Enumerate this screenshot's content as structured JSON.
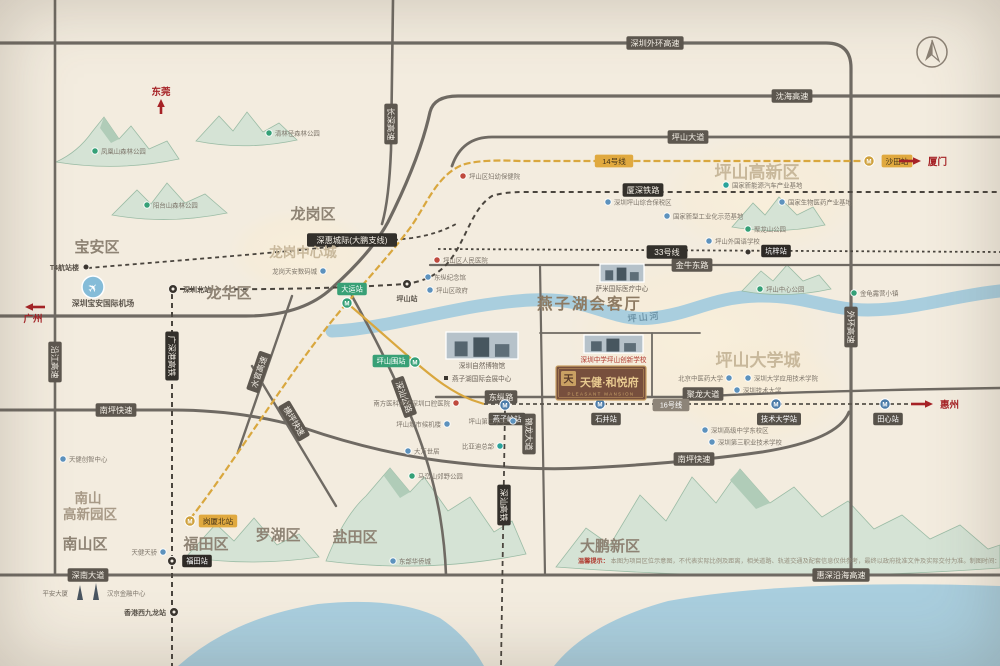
{
  "page": {
    "width": 1000,
    "height": 666,
    "bg": "#f3ecdf"
  },
  "airport": {
    "name": "深圳宝安国际机场"
  },
  "project": {
    "name": "天健·和悦府",
    "en": "PLEASANT MANSION",
    "seal": "天"
  },
  "river_label": "坪山河",
  "disclaimer": {
    "prefix": "温馨提示：",
    "text": "本图为项目区位示意图，不代表实际比例及距离，相关道路、轨道交通及配套信息仅供参考，最终以政府批准文件及实际交付为准。制图时间：2023年3月。"
  },
  "colors": {
    "road": "#6f6a63",
    "rail": "#4a453e",
    "metro_gold": "#d9a73e",
    "river": "#a9cede",
    "accent_red": "#a62226",
    "zone_text": "#c8b89b"
  },
  "arrows": [
    {
      "label": "东莞",
      "x": 161,
      "y": 114,
      "tx": 161,
      "ty": 99,
      "lx": 161,
      "ly": 95,
      "anchor": "middle"
    },
    {
      "label": "广州",
      "x": 45,
      "y": 307,
      "tx": 25,
      "ty": 307,
      "lx": 33,
      "ly": 322,
      "anchor": "middle"
    },
    {
      "label": "厦门",
      "x": 899,
      "y": 161,
      "tx": 921,
      "ty": 161,
      "lx": 928,
      "ly": 165,
      "anchor": "start"
    },
    {
      "label": "惠州",
      "x": 911,
      "y": 404,
      "tx": 933,
      "ty": 404,
      "lx": 940,
      "ly": 408,
      "anchor": "start"
    }
  ],
  "regions": [
    {
      "text": "宝安区",
      "x": 97,
      "y": 252,
      "fs": 15,
      "fill": "#8e8374",
      "bold": 1
    },
    {
      "text": "龙岗区",
      "x": 313,
      "y": 219,
      "fs": 15,
      "fill": "#8e8374",
      "bold": 1
    },
    {
      "text": "龙华区",
      "x": 229,
      "y": 298,
      "fs": 15,
      "fill": "#8e8374",
      "bold": 1
    },
    {
      "text": "南山区",
      "x": 85,
      "y": 549,
      "fs": 15,
      "fill": "#8e8374",
      "bold": 1
    },
    {
      "text": "福田区",
      "x": 206,
      "y": 549,
      "fs": 15,
      "fill": "#8e8374",
      "bold": 1
    },
    {
      "text": "罗湖区",
      "x": 278,
      "y": 540,
      "fs": 15,
      "fill": "#8e8374",
      "bold": 1
    },
    {
      "text": "盐田区",
      "x": 355,
      "y": 542,
      "fs": 15,
      "fill": "#8e8374",
      "bold": 1
    },
    {
      "text": "大鹏新区",
      "x": 610,
      "y": 551,
      "fs": 15,
      "fill": "#8e8374",
      "bold": 1
    },
    {
      "text": "南山",
      "x": 88,
      "y": 503,
      "fs": 13.5,
      "fill": "#a89a87",
      "bold": 1
    },
    {
      "text": "高新园区",
      "x": 90,
      "y": 519,
      "fs": 13.5,
      "fill": "#a89a87",
      "bold": 1
    },
    {
      "text": "龙岗中心城",
      "x": 303,
      "y": 257,
      "fs": 13.5,
      "fill": "#c8b89b",
      "serif": 1,
      "bold": 1
    },
    {
      "text": "坪山高新区",
      "x": 757,
      "y": 178,
      "fs": 17,
      "fill": "#c8b89b",
      "serif": 1,
      "bold": 1
    },
    {
      "text": "坪山大学城",
      "x": 758,
      "y": 366,
      "fs": 17,
      "fill": "#c8b89b",
      "serif": 1,
      "bold": 1
    },
    {
      "text": "燕子湖会客厅",
      "x": 537,
      "y": 309,
      "fs": 15.5,
      "fill": "#8d7a62",
      "serif": 1,
      "bold": 1,
      "anchor": "start",
      "ls": 2
    }
  ],
  "road_labels": [
    {
      "text": "深圳外环高速",
      "x": 655,
      "y": 43
    },
    {
      "text": "沈海高速",
      "x": 792,
      "y": 96
    },
    {
      "text": "坪山大道",
      "x": 688,
      "y": 137
    },
    {
      "text": "金牛东路",
      "x": 692,
      "y": 265
    },
    {
      "text": "东纵路",
      "x": 501,
      "y": 397
    },
    {
      "text": "聚龙大道",
      "x": 703,
      "y": 394
    },
    {
      "text": "南坪快速",
      "x": 116,
      "y": 410
    },
    {
      "text": "南坪快速",
      "x": 694,
      "y": 459
    },
    {
      "text": "深南大道",
      "x": 88,
      "y": 575
    },
    {
      "text": "惠深沿海高速",
      "x": 841,
      "y": 575
    },
    {
      "text": "长深高速",
      "x": 391,
      "y": 124,
      "rot": 90
    },
    {
      "text": "沿江高速",
      "x": 55,
      "y": 362,
      "rot": 90
    },
    {
      "text": "外环高速",
      "x": 851,
      "y": 327,
      "rot": 90
    },
    {
      "text": "锦龙大道",
      "x": 529,
      "y": 434,
      "rot": 90
    },
    {
      "text": "深汕公路",
      "x": 404,
      "y": 397,
      "rot": 70
    },
    {
      "text": "水官高速",
      "x": 259,
      "y": 372,
      "rot": -71
    },
    {
      "text": "横坪快速",
      "x": 294,
      "y": 421,
      "rot": 59
    },
    {
      "text": "厦深铁路",
      "x": 643,
      "y": 190,
      "kind": "rail"
    },
    {
      "text": "广深港高铁",
      "x": 172,
      "y": 356,
      "rot": 90,
      "kind": "rail"
    },
    {
      "text": "深惠城际(大鹏支线)",
      "x": 352,
      "y": 240,
      "kind": "rail"
    },
    {
      "text": "深汕高铁",
      "x": 504,
      "y": 505,
      "rot": 90,
      "kind": "rail"
    },
    {
      "text": "14号线",
      "x": 614,
      "y": 161,
      "kind": "gold"
    },
    {
      "text": "33号线",
      "x": 667,
      "y": 252,
      "kind": "rail"
    },
    {
      "text": "16号线",
      "x": 671,
      "y": 405,
      "kind": "gray"
    }
  ],
  "stations": [
    {
      "name": "深圳北站",
      "x": 173,
      "y": 289,
      "icon": "rail",
      "lx": 183,
      "ly": 292,
      "anchor": "start"
    },
    {
      "name": "T4航站楼",
      "x": 86,
      "y": 267,
      "icon": "dot",
      "lx": 79,
      "ly": 270,
      "anchor": "end"
    },
    {
      "name": "坪山站",
      "x": 407,
      "y": 284,
      "icon": "rail",
      "lx": 407,
      "ly": 301,
      "anchor": "middle"
    },
    {
      "name": "福田站",
      "x": 172,
      "y": 561,
      "icon": "rail",
      "badge": "black",
      "lx": 197,
      "ly": 561
    },
    {
      "name": "香港西九龙站",
      "x": 174,
      "y": 612,
      "icon": "rail",
      "lx": 166,
      "ly": 615,
      "anchor": "end"
    },
    {
      "name": "岗厦北站",
      "x": 190,
      "y": 521,
      "icon": "m",
      "color": "#cfa13d",
      "badge": "gold",
      "lx": 218,
      "ly": 521
    },
    {
      "name": "大运站",
      "x": 347,
      "y": 303,
      "icon": "m",
      "color": "#35a077",
      "badge": "green",
      "lx": 352,
      "ly": 289
    },
    {
      "name": "坪山围站",
      "x": 415,
      "y": 362,
      "icon": "m",
      "color": "#35a077",
      "badge": "green",
      "lx": 391,
      "ly": 361
    },
    {
      "name": "燕子岭站",
      "x": 505,
      "y": 405,
      "icon": "m",
      "color": "#4b7ba8",
      "badge": "dark",
      "lx": 507,
      "ly": 419
    },
    {
      "name": "石井站",
      "x": 600,
      "y": 404,
      "icon": "m",
      "color": "#4b7ba8",
      "badge": "dark",
      "lx": 606,
      "ly": 419
    },
    {
      "name": "技术大学站",
      "x": 776,
      "y": 404,
      "icon": "m",
      "color": "#4b7ba8",
      "badge": "dark",
      "lx": 779,
      "ly": 419
    },
    {
      "name": "田心站",
      "x": 885,
      "y": 404,
      "icon": "m",
      "color": "#4b7ba8",
      "badge": "dark",
      "lx": 888,
      "ly": 419
    },
    {
      "name": "坑梓站",
      "x": 748,
      "y": 252,
      "icon": "dot",
      "badge": "black",
      "lx": 776,
      "ly": 251
    },
    {
      "name": "沙田站",
      "x": 869,
      "y": 161,
      "icon": "m",
      "color": "#cfa13d",
      "badge": "gold",
      "lx": 897,
      "ly": 161
    }
  ],
  "pois": [
    {
      "name": "凤凰山森林公园",
      "x": 95,
      "y": 151,
      "color": "green",
      "side": "r"
    },
    {
      "name": "清林径森林公园",
      "x": 269,
      "y": 133,
      "color": "green",
      "side": "r"
    },
    {
      "name": "阳台山森林公园",
      "x": 147,
      "y": 205,
      "color": "green",
      "side": "r"
    },
    {
      "name": "龙岗天安数码城",
      "x": 323,
      "y": 271,
      "color": "blue",
      "side": "l"
    },
    {
      "name": "东纵纪念馆",
      "x": 428,
      "y": 277,
      "color": "blue",
      "side": "r"
    },
    {
      "name": "坪山区政府",
      "x": 430,
      "y": 290,
      "color": "blue",
      "side": "r"
    },
    {
      "name": "坪山区妇幼保健院",
      "x": 463,
      "y": 176,
      "color": "red",
      "side": "r"
    },
    {
      "name": "深圳坪山综合保税区",
      "x": 608,
      "y": 202,
      "color": "blue",
      "side": "r"
    },
    {
      "name": "坪山区人民医院",
      "x": 437,
      "y": 260,
      "color": "red",
      "side": "r"
    },
    {
      "name": "国家新能源汽车产业基地",
      "x": 726,
      "y": 185,
      "color": "teal",
      "side": "r"
    },
    {
      "name": "国家生物医药产业基地",
      "x": 782,
      "y": 202,
      "color": "blue",
      "side": "r"
    },
    {
      "name": "国家新型工业化示范基地",
      "x": 667,
      "y": 216,
      "color": "blue",
      "side": "r"
    },
    {
      "name": "聚龙山公园",
      "x": 748,
      "y": 229,
      "color": "green",
      "side": "r"
    },
    {
      "name": "坪山外国语学校",
      "x": 709,
      "y": 241,
      "color": "blue",
      "side": "r"
    },
    {
      "name": "坪山中心公园",
      "x": 760,
      "y": 289,
      "color": "green",
      "side": "r"
    },
    {
      "name": "金龟露营小镇",
      "x": 854,
      "y": 293,
      "color": "green",
      "side": "r"
    },
    {
      "name": "北京中医药大学",
      "x": 729,
      "y": 378,
      "color": "blue",
      "side": "l"
    },
    {
      "name": "深圳大学应用技术学院",
      "x": 748,
      "y": 378,
      "color": "blue",
      "side": "r"
    },
    {
      "name": "深圳技术大学",
      "x": 737,
      "y": 390,
      "color": "blue",
      "side": "r"
    },
    {
      "name": "深圳高级中学东校区",
      "x": 705,
      "y": 430,
      "color": "blue",
      "side": "r"
    },
    {
      "name": "深圳第三职业技术学校",
      "x": 712,
      "y": 442,
      "color": "blue",
      "side": "r"
    },
    {
      "name": "南方医科大学深圳口腔医院",
      "x": 456,
      "y": 403,
      "color": "red",
      "side": "l"
    },
    {
      "name": "坪山城市候机楼",
      "x": 447,
      "y": 424,
      "color": "blue",
      "side": "l"
    },
    {
      "name": "坪山第二小学",
      "x": 513,
      "y": 421,
      "color": "blue",
      "side": "l"
    },
    {
      "name": "比亚迪总部",
      "x": 500,
      "y": 446,
      "color": "teal",
      "side": "l"
    },
    {
      "name": "大万世居",
      "x": 408,
      "y": 451,
      "color": "blue",
      "side": "r"
    },
    {
      "name": "马峦山郊野公园",
      "x": 412,
      "y": 476,
      "color": "green",
      "side": "r"
    },
    {
      "name": "东部华侨城",
      "x": 393,
      "y": 561,
      "color": "blue",
      "side": "r"
    },
    {
      "name": "天健创智中心",
      "x": 63,
      "y": 459,
      "color": "blue",
      "side": "r"
    },
    {
      "name": "天健天骄",
      "x": 163,
      "y": 552,
      "color": "blue",
      "side": "l"
    },
    {
      "name": "平安大厦",
      "x": 74,
      "y": 593,
      "color": "plain",
      "side": "l"
    },
    {
      "name": "汉京金融中心",
      "x": 101,
      "y": 593,
      "color": "plain",
      "side": "r"
    }
  ],
  "landmarks": [
    {
      "name": "萨米国际医疗中心",
      "x": 600,
      "y": 264,
      "w": 44,
      "h": 18,
      "thumb": true,
      "cap": "#6b6258"
    },
    {
      "name": "深圳自然博物馆",
      "x": 446,
      "y": 332,
      "w": 72,
      "h": 27,
      "thumb": true,
      "cap": "#6b6258"
    },
    {
      "name": "燕子湖国际会展中心",
      "x": 452,
      "y": 381,
      "thumb": false,
      "cap": "#6b6258"
    },
    {
      "name": "深圳中学坪山创新学校",
      "x": 584,
      "y": 335,
      "w": 59,
      "h": 18,
      "thumb": true,
      "cap": "#b03a30"
    }
  ],
  "zones": [
    {
      "x": 300,
      "y": 252,
      "rx": 72,
      "ry": 44
    },
    {
      "x": 760,
      "y": 196,
      "rx": 100,
      "ry": 62
    },
    {
      "x": 700,
      "y": 338,
      "rx": 132,
      "ry": 86
    },
    {
      "x": 762,
      "y": 392,
      "rx": 88,
      "ry": 56
    }
  ]
}
